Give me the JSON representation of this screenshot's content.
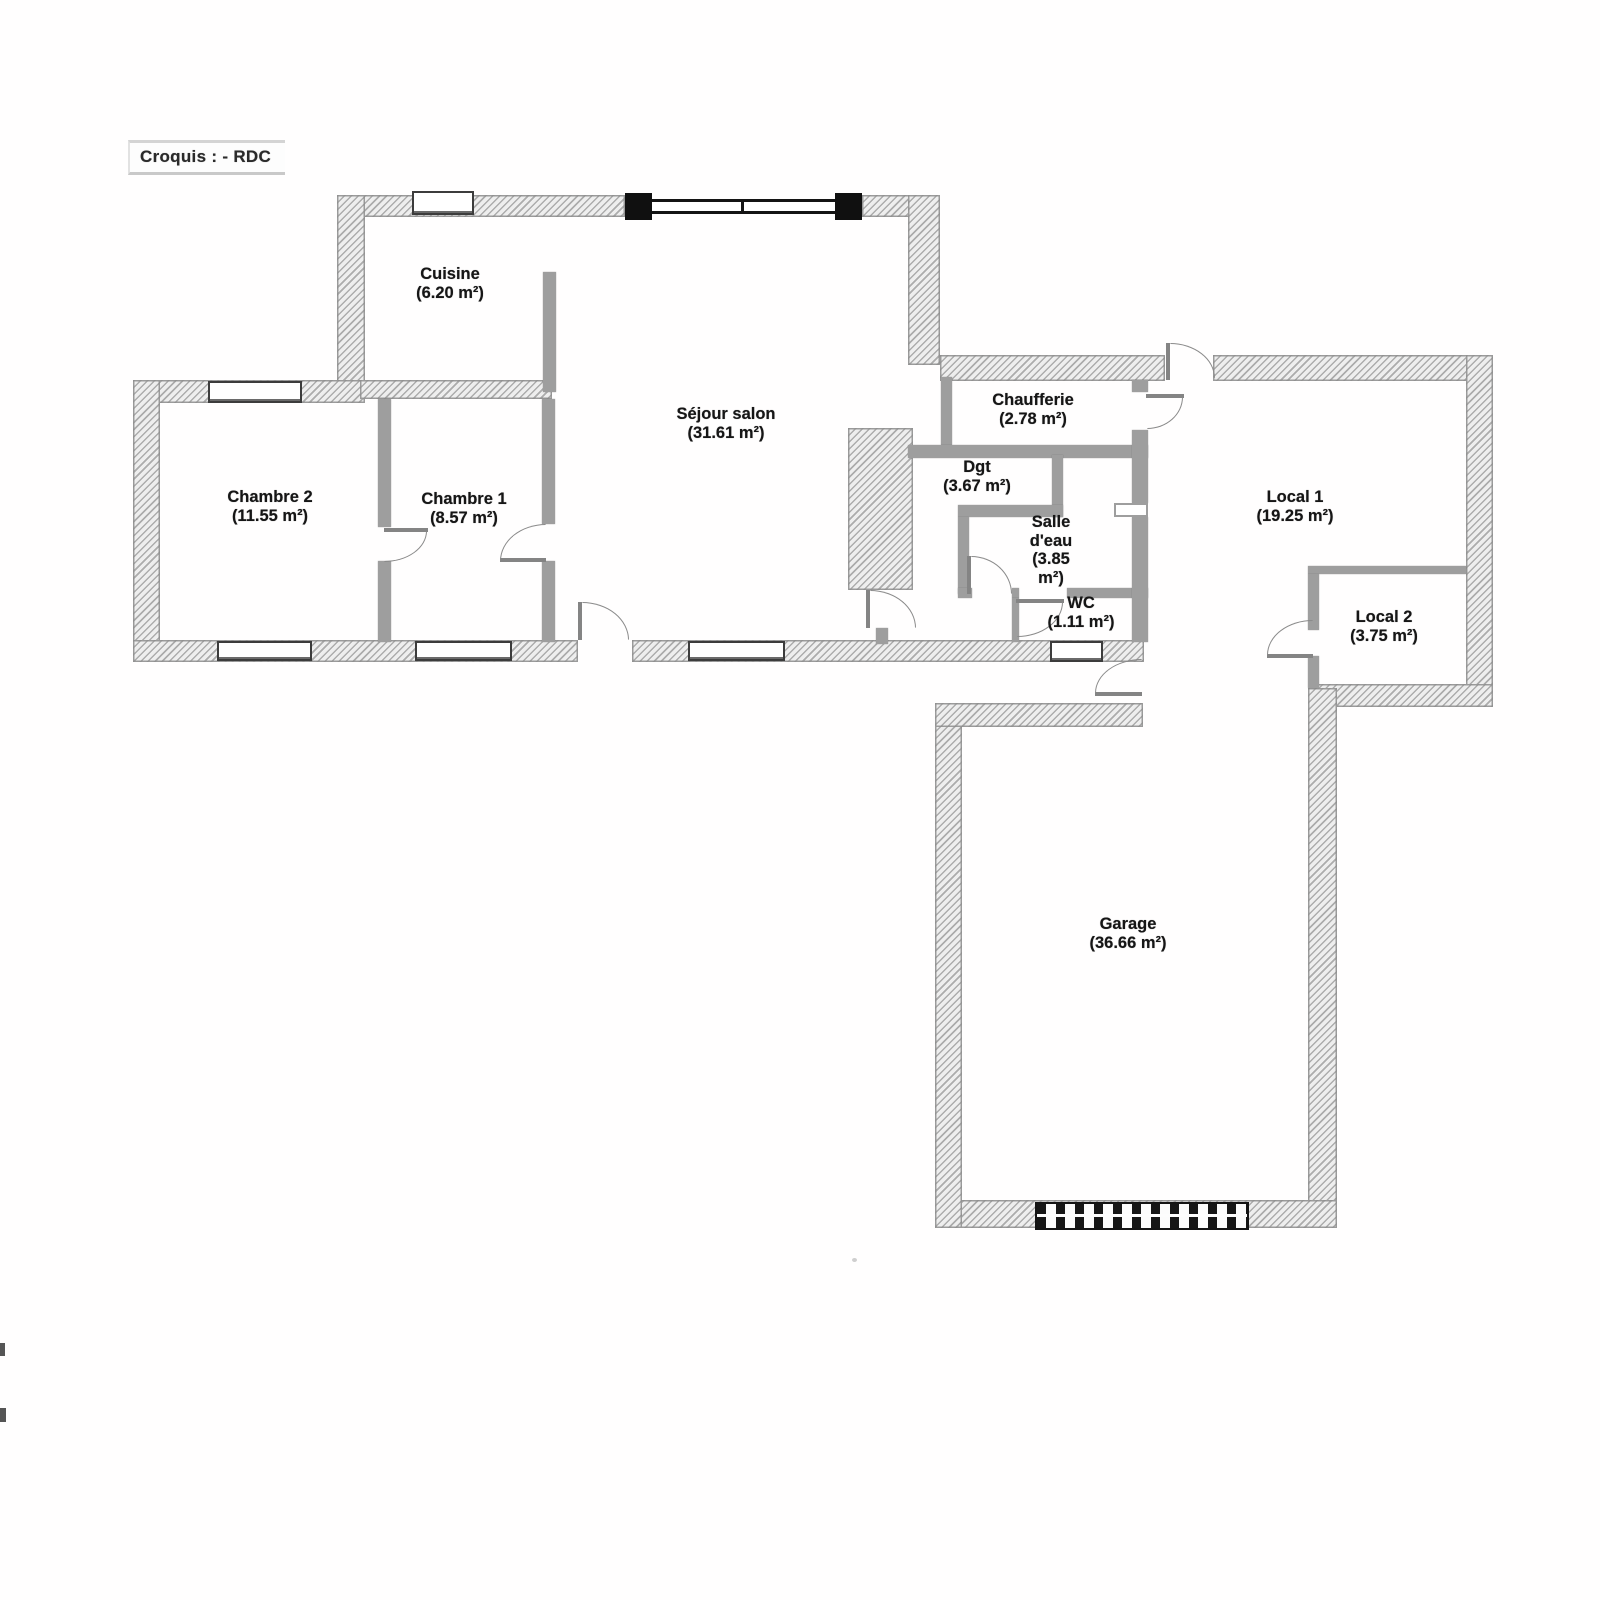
{
  "title": "Croquis : - RDC",
  "rooms": {
    "cuisine": {
      "name": "Cuisine",
      "area": "(6.20 m²)"
    },
    "chambre2": {
      "name": "Chambre 2",
      "area": "(11.55 m²)"
    },
    "chambre1": {
      "name": "Chambre 1",
      "area": "(8.57 m²)"
    },
    "sejour": {
      "name": "Séjour salon",
      "area": "(31.61 m²)"
    },
    "chaufferie": {
      "name": "Chaufferie",
      "area": "(2.78 m²)"
    },
    "dgt": {
      "name": "Dgt",
      "area": "(3.67 m²)"
    },
    "salle_deau": {
      "name": "Salle d'eau",
      "area": "(3.85 m²)"
    },
    "wc": {
      "name": "WC",
      "area": "(1.11 m²)"
    },
    "local1": {
      "name": "Local 1",
      "area": "(19.25 m²)"
    },
    "local2": {
      "name": "Local 2",
      "area": "(3.75 m²)"
    },
    "garage": {
      "name": "Garage",
      "area": "(36.66 m²)"
    }
  },
  "colors": {
    "ink": "#161616",
    "wall_grey": "#9e9e9e",
    "hatch_grey": "#bdbdbd",
    "paper": "#ffffff"
  }
}
